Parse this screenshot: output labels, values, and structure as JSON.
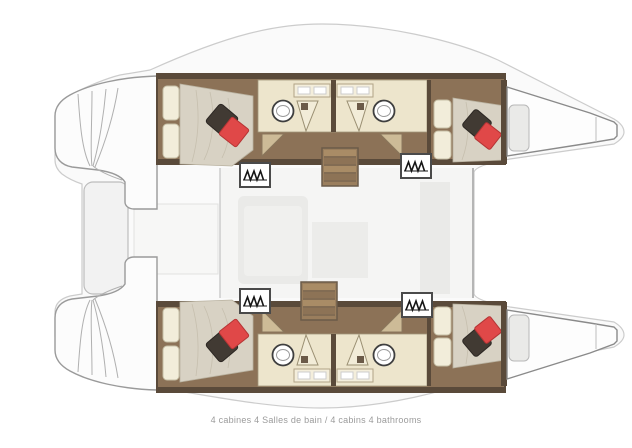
{
  "caption": {
    "text": "4 cabines 4 Salles de bain / 4 cabins 4 bathrooms"
  },
  "spec": {
    "cabins": 4,
    "bathrooms": 4
  },
  "palette": {
    "red_accent": "#e04848",
    "red_accent_edge": "#b53434",
    "dark_cushion": "#413a33",
    "wood_floor": "#8c7257",
    "wall": "#5a4a3a",
    "bathroom_floor": "#ede5cc",
    "bed_linen": "#d8d2c4",
    "pillow_cream": "#f2edda",
    "deck": "#fafafa",
    "saloon": "#f5f5f4",
    "outline": "#9a9a9a",
    "caption_text": "#9b9b9b"
  },
  "icons": [
    "stairs-icon",
    "sink-icon",
    "shower-door-icon",
    "door-swing-icon"
  ]
}
